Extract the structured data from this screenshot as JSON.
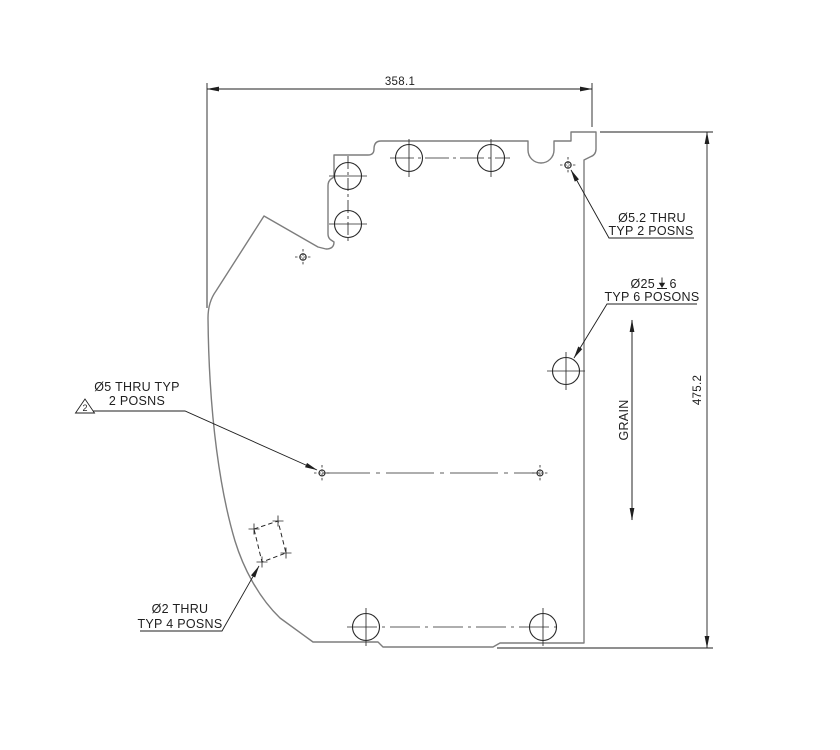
{
  "drawing": {
    "dim_width": {
      "value": "358.1"
    },
    "dim_height": {
      "value": "475.2"
    },
    "grain": {
      "label": "GRAIN"
    },
    "callout_hole_52": {
      "line1": "Ø5.2 THRU",
      "line2": "TYP 2 POSNS"
    },
    "callout_hole_25": {
      "diameter": "Ø25",
      "depth_icon": "depth-symbol",
      "depth_value": "6",
      "line2": "TYP 6 POSONS"
    },
    "callout_hole_5": {
      "line1": "Ø5 THRU TYP",
      "line2": "2 POSNS"
    },
    "callout_hole_2": {
      "line1": "Ø2 THRU",
      "line2": "TYP 4 POSNS"
    },
    "flag_note": {
      "number": "2"
    },
    "colors": {
      "outline": "#7d7d7d",
      "annotation": "#1f1f1f",
      "background": "#ffffff"
    }
  }
}
